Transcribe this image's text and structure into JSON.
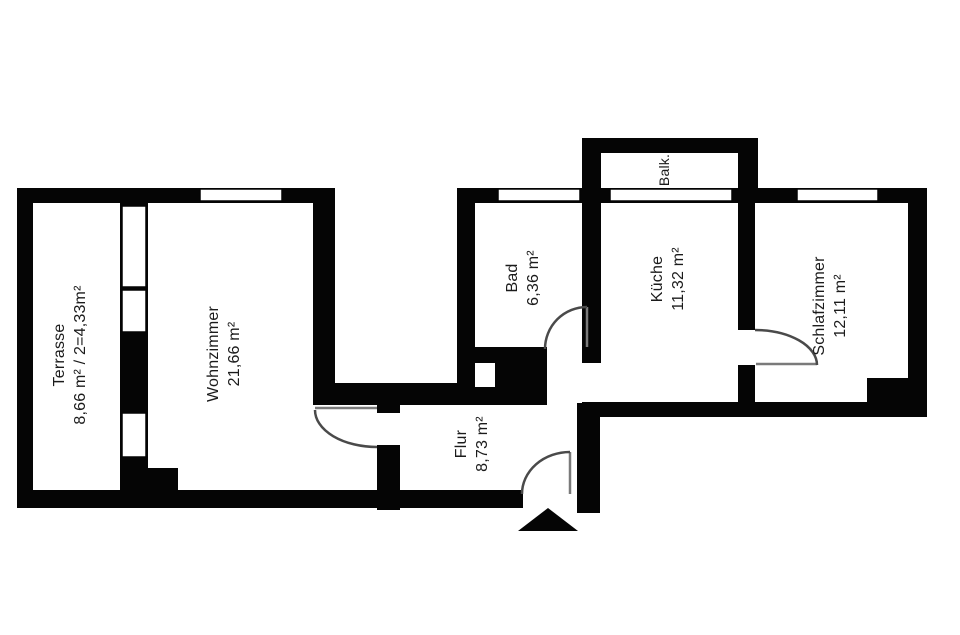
{
  "floorplan": {
    "title": "apartment-floor-plan",
    "rooms": [
      {
        "id": "terrasse",
        "name": "Terrasse",
        "area": "8,66 m² / 2=4,33m²"
      },
      {
        "id": "wohnzimmer",
        "name": "Wohnzimmer",
        "area": "21,66 m²"
      },
      {
        "id": "bad",
        "name": "Bad",
        "area": "6,36 m²"
      },
      {
        "id": "kueche",
        "name": "Küche",
        "area": "11,32 m²"
      },
      {
        "id": "balkon",
        "name": "Balk.",
        "area": ""
      },
      {
        "id": "schlafzimmer",
        "name": "Schlafzimmer",
        "area": "12,11 m²"
      },
      {
        "id": "flur",
        "name": "Flur",
        "area": "8,73 m²"
      }
    ],
    "colors": {
      "wall": "#050505",
      "background": "#ffffff",
      "door_arc": "#4a4a4a",
      "door_leaf": "#7a7a7a",
      "text": "#1b1b1b"
    }
  }
}
